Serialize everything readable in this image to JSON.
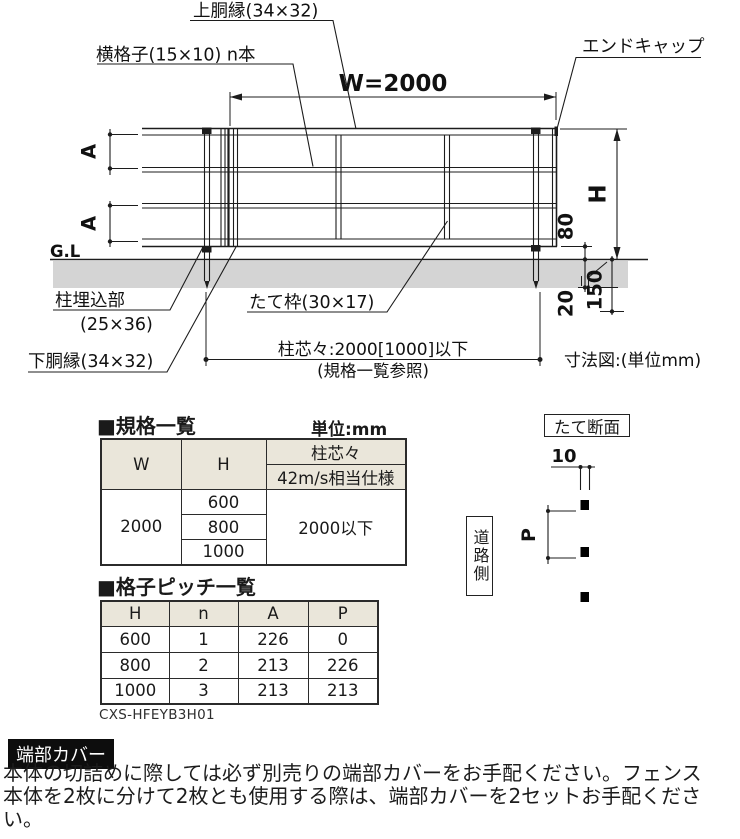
{
  "colors": {
    "line": "#1c1c1c",
    "ground_band": "#d4d4d4",
    "table_header_bg": "#eae6da",
    "note_box_bg": "#0d0d0d",
    "note_box_text": "#ffffff"
  },
  "drawing": {
    "label_top_rail": "上胴縁(34×32)",
    "label_lattice": "横格子(15×10) n本",
    "label_end_cap": "エンドキャップ",
    "dim_w": "W=2000",
    "dim_h": "H",
    "dim_a1": "A",
    "dim_a2": "A",
    "label_gl": "G.L",
    "dim_80": "80",
    "dim_20": "20",
    "dim_150": "150",
    "label_post_embed_line1": "柱埋込部",
    "label_post_embed_line2": "(25×36)",
    "label_vertical_frame": "たて枠(30×17)",
    "label_bottom_rail": "下胴縁(34×32)",
    "dim_post_pitch": "柱芯々:2000[1000]以下",
    "dim_post_pitch_ref": "(規格一覧参照)",
    "caption": "寸法図:(単位mm)"
  },
  "section": {
    "title": "たて断面",
    "dim_10": "10",
    "dim_p": "P",
    "road_side": "道路側"
  },
  "spec_table": {
    "title": "■規格一覧",
    "unit_label": "単位:mm",
    "col_w": "W",
    "col_h": "H",
    "col_post_pitch": "柱芯々",
    "col_wind_spec": "42m/s相当仕様",
    "w_value": "2000",
    "h_values": [
      "600",
      "800",
      "1000"
    ],
    "post_pitch_value": "2000以下"
  },
  "pitch_table": {
    "title": "■格子ピッチ一覧",
    "headers": [
      "H",
      "n",
      "A",
      "P"
    ],
    "rows": [
      [
        "600",
        "1",
        "226",
        "0"
      ],
      [
        "800",
        "2",
        "213",
        "226"
      ],
      [
        "1000",
        "3",
        "213",
        "213"
      ]
    ]
  },
  "product_code": "CXS-HFEYB3H01",
  "note": {
    "title": "端部カバー",
    "body": "本体の切詰めに際しては必ず別売りの端部カバーをお手配ください。フェンス本体を2枚に分けて2枚とも使用する際は、端部カバーを2セットお手配ください。"
  }
}
